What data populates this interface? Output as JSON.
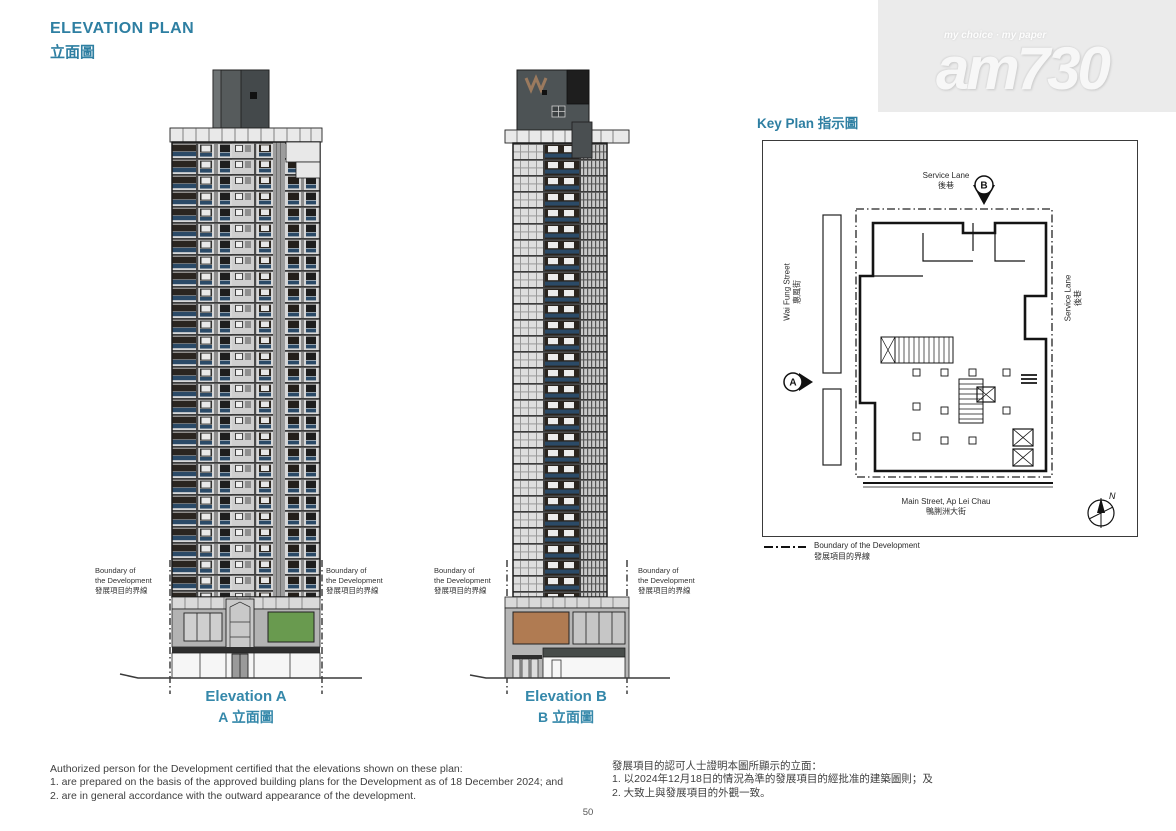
{
  "page": {
    "title_en": "ELEVATION PLAN",
    "title_zh": "立面圖",
    "page_number": "50"
  },
  "watermark": {
    "tagline": "my choice · my paper",
    "brand": "am730"
  },
  "boundary_label": {
    "en1": "Boundary of",
    "en2": "the Development",
    "zh": "發展項目的界線"
  },
  "elevations": [
    {
      "label_en": "Elevation A",
      "label_zh": "A 立面圖"
    },
    {
      "label_en": "Elevation B",
      "label_zh": "B 立面圖"
    }
  ],
  "key_plan": {
    "title": "Key Plan 指示圖",
    "streets": {
      "top_en": "Service Lane",
      "top_zh": "後巷",
      "left_en": "Wai Fung Street",
      "left_zh": "惠風街",
      "right_en": "Service Lane",
      "right_zh": "後巷",
      "bottom_en": "Main Street, Ap Lei Chau",
      "bottom_zh": "鴨脷洲大街"
    },
    "markers": {
      "a": "A",
      "b": "B",
      "north": "N"
    },
    "legend_en": "Boundary of the Development",
    "legend_zh": "發展項目的界線"
  },
  "notes": {
    "en": [
      "Authorized person for the Development certified that the elevations shown on these plan:",
      "1. are prepared on the basis of the approved building plans for the Development as of 18 December 2024; and",
      "2. are in general accordance with the outward appearance of the development."
    ],
    "zh": [
      "發展項目的認可人士證明本圖所顯示的立面：",
      "1. 以2024年12月18日的情況為準的發展項目的經批准的建築圖則；及",
      "2. 大致上與發展項目的外觀一致。"
    ]
  },
  "colors": {
    "accent": "#2e7fa2",
    "facade_navy": "#2b4a67",
    "podium_green": "#699a4f",
    "podium_brown": "#b07b52"
  }
}
